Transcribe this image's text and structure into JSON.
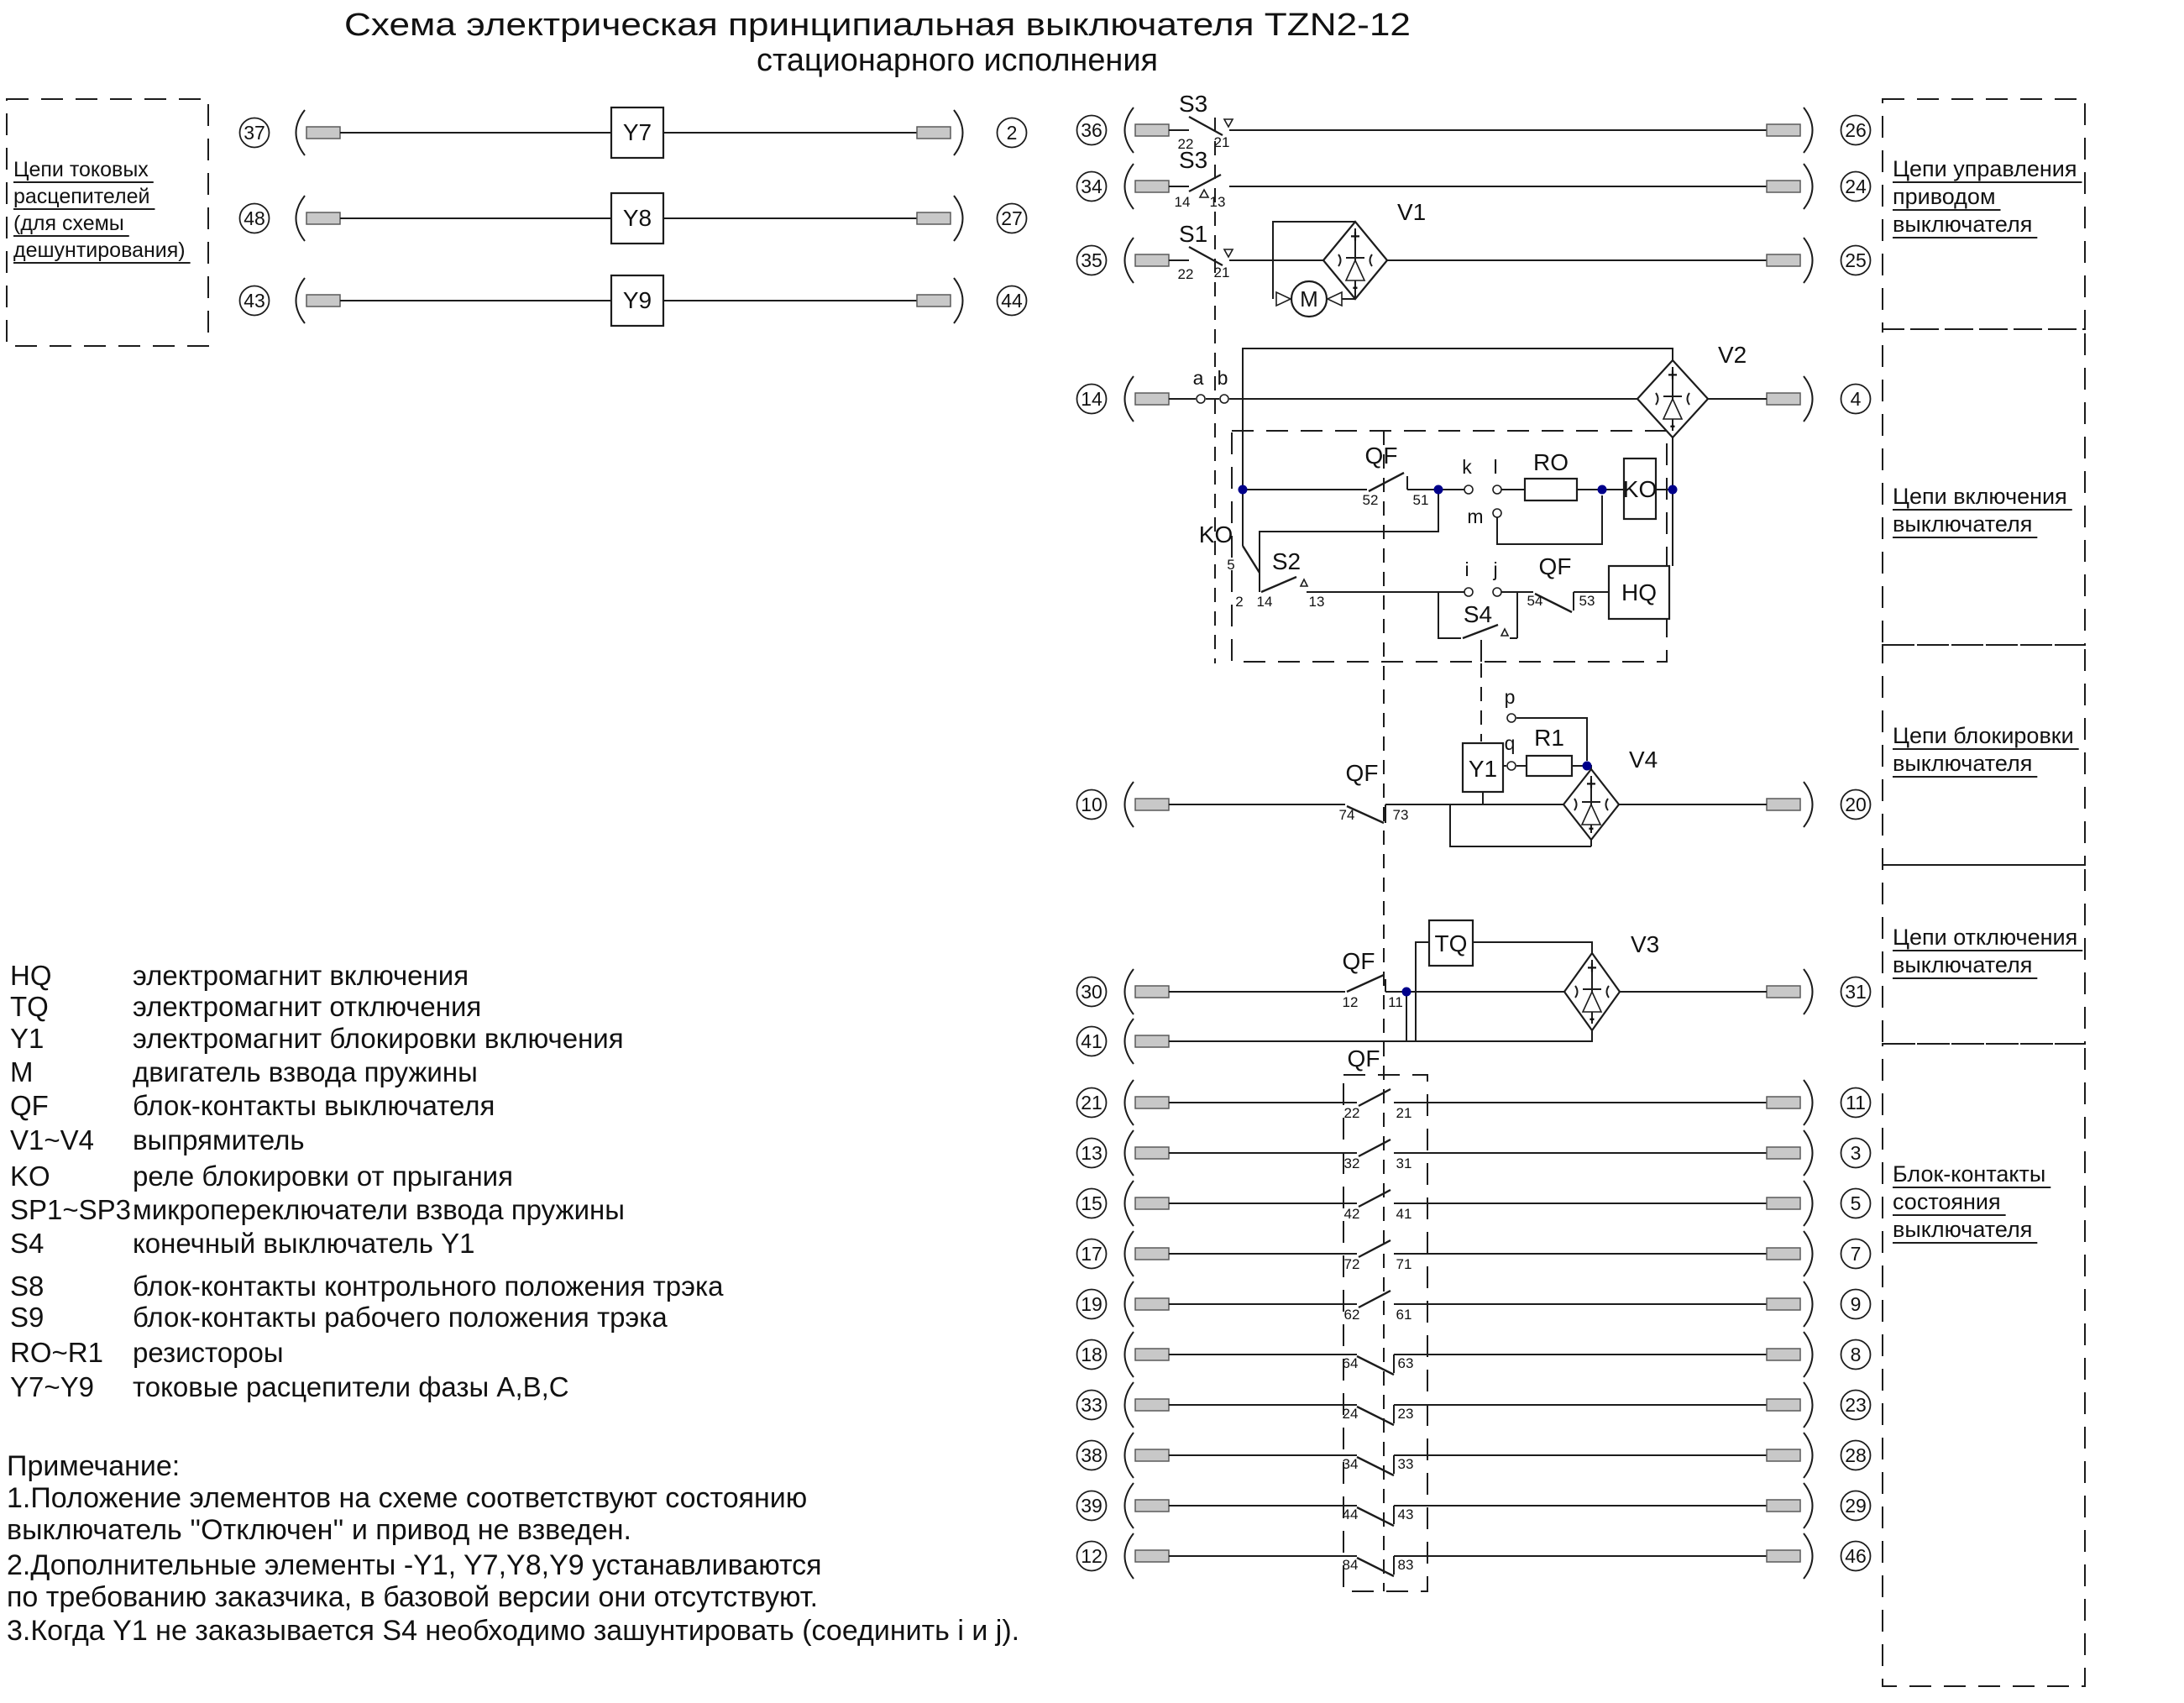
{
  "title": {
    "line1": "Схема электрическая принципиальная выключателя TZN2-12",
    "line2": "стационарного исполнения"
  },
  "left_box": {
    "lines": [
      "Цепи токовых",
      "расцепителей",
      "(для схемы",
      "дешунтирования)"
    ]
  },
  "trip_rows": [
    {
      "left": "37",
      "device": "Y7",
      "right": "2"
    },
    {
      "left": "48",
      "device": "Y8",
      "right": "27"
    },
    {
      "left": "43",
      "device": "Y9",
      "right": "44"
    }
  ],
  "top_rows": [
    {
      "left": "36",
      "switch": "S3",
      "c1": "22",
      "c2": "21",
      "right": "26",
      "type": "down"
    },
    {
      "left": "34",
      "switch": "S3",
      "c1": "14",
      "c2": "13",
      "right": "24",
      "type": "up"
    },
    {
      "left": "35",
      "switch": "S1",
      "c1": "22",
      "c2": "21",
      "right": "25",
      "type": "down"
    }
  ],
  "motor_drive": {
    "v1": "V1",
    "m": "M"
  },
  "closing": {
    "left": "14",
    "right": "4",
    "a": "a",
    "b": "b",
    "v2": "V2",
    "qf_label": "QF",
    "qf_c1": "52",
    "qf_c2": "51",
    "k": "k",
    "l": "l",
    "m": "m",
    "ro": "RO",
    "ko_coil": "KO",
    "ko_label": "KO",
    "ko_c1": "5",
    "ko_c2": "2",
    "s2": "S2",
    "s2_c1": "14",
    "s2_c2": "13",
    "i": "i",
    "j": "j",
    "s4": "S4",
    "qf2_label": "QF",
    "qf2_c1": "54",
    "qf2_c2": "53",
    "hq": "HQ"
  },
  "locking": {
    "left": "10",
    "right": "20",
    "qf_label": "QF",
    "qf_c1": "74",
    "qf_c2": "73",
    "y1": "Y1",
    "q": "q",
    "p": "p",
    "r1": "R1",
    "v4": "V4"
  },
  "tripping": {
    "left1": "30",
    "right1": "31",
    "left2": "41",
    "qf_label": "QF",
    "qf_c1": "12",
    "qf_c2": "11",
    "qf2_label": "QF",
    "tq": "TQ",
    "v3": "V3"
  },
  "block_rows": [
    {
      "left": "21",
      "c1": "22",
      "c2": "21",
      "right": "11",
      "type": "no"
    },
    {
      "left": "13",
      "c1": "32",
      "c2": "31",
      "right": "3",
      "type": "no"
    },
    {
      "left": "15",
      "c1": "42",
      "c2": "41",
      "right": "5",
      "type": "no"
    },
    {
      "left": "17",
      "c1": "72",
      "c2": "71",
      "right": "7",
      "type": "no"
    },
    {
      "left": "19",
      "c1": "62",
      "c2": "61",
      "right": "9",
      "type": "no"
    },
    {
      "left": "18",
      "c1": "64",
      "c2": "63",
      "right": "8",
      "type": "nc"
    },
    {
      "left": "33",
      "c1": "24",
      "c2": "23",
      "right": "23",
      "type": "nc"
    },
    {
      "left": "38",
      "c1": "34",
      "c2": "33",
      "right": "28",
      "type": "nc"
    },
    {
      "left": "39",
      "c1": "44",
      "c2": "43",
      "right": "29",
      "type": "nc"
    },
    {
      "left": "12",
      "c1": "84",
      "c2": "83",
      "right": "46",
      "type": "nc"
    }
  ],
  "section_labels": [
    {
      "lines": [
        "Цепи управления",
        "приводом",
        "выключателя"
      ]
    },
    {
      "lines": [
        "Цепи включения",
        "выключателя"
      ]
    },
    {
      "lines": [
        "Цепи блокировки",
        "выключателя"
      ]
    },
    {
      "lines": [
        "Цепи отключения",
        "выключателя"
      ]
    },
    {
      "lines": [
        "Блок-контакты",
        "состояния",
        "выключателя"
      ]
    }
  ],
  "legend": [
    {
      "sym": "HQ",
      "desc": "электромагнит включения"
    },
    {
      "sym": "TQ",
      "desc": "электромагнит отключения"
    },
    {
      "sym": "Y1",
      "desc": "электромагнит блокировки включения"
    },
    {
      "sym": "M",
      "desc": "двигатель взвода пружины"
    },
    {
      "sym": "QF",
      "desc": "блок-контакты выключателя"
    },
    {
      "sym": "V1~V4",
      "desc": "выпрямитель"
    },
    {
      "sym": "KO",
      "desc": "реле блокировки от прыгания"
    },
    {
      "sym": "SP1~SP3",
      "desc": "микропереключатели взвода пружины"
    },
    {
      "sym": "S4",
      "desc": "конечный выключатель Y1"
    },
    {
      "sym": "S8",
      "desc": "блок-контакты контрольного положения трэка"
    },
    {
      "sym": "S9",
      "desc": "блок-контакты рабочего  положения трэка"
    },
    {
      "sym": "RO~R1",
      "desc": "резистороы"
    },
    {
      "sym": "Y7~Y9",
      "desc": "токовые расцепители фазы A,B,C"
    }
  ],
  "notes": {
    "heading": "Примечание:",
    "lines": [
      "1.Положение элементов на схеме соответствуют состоянию",
      "выключатель ''Отключен'' и привод не взведен.",
      "2.Дополнительные элементы -Y1, Y7,Y8,Y9 устанавливаются",
      "по требованию заказчика,  в базовой версии они отсутствуют.",
      "3.Когда Y1 не заказывается  S4 необходимо зашунтировать (соединить i и j)."
    ]
  },
  "symbols": {
    "plus": "+",
    "minus": "-"
  },
  "colors": {
    "line": "#1c1c1c",
    "junction_dot": "#00008b",
    "plug_fill": "#c8c8c8",
    "background": "#ffffff"
  }
}
